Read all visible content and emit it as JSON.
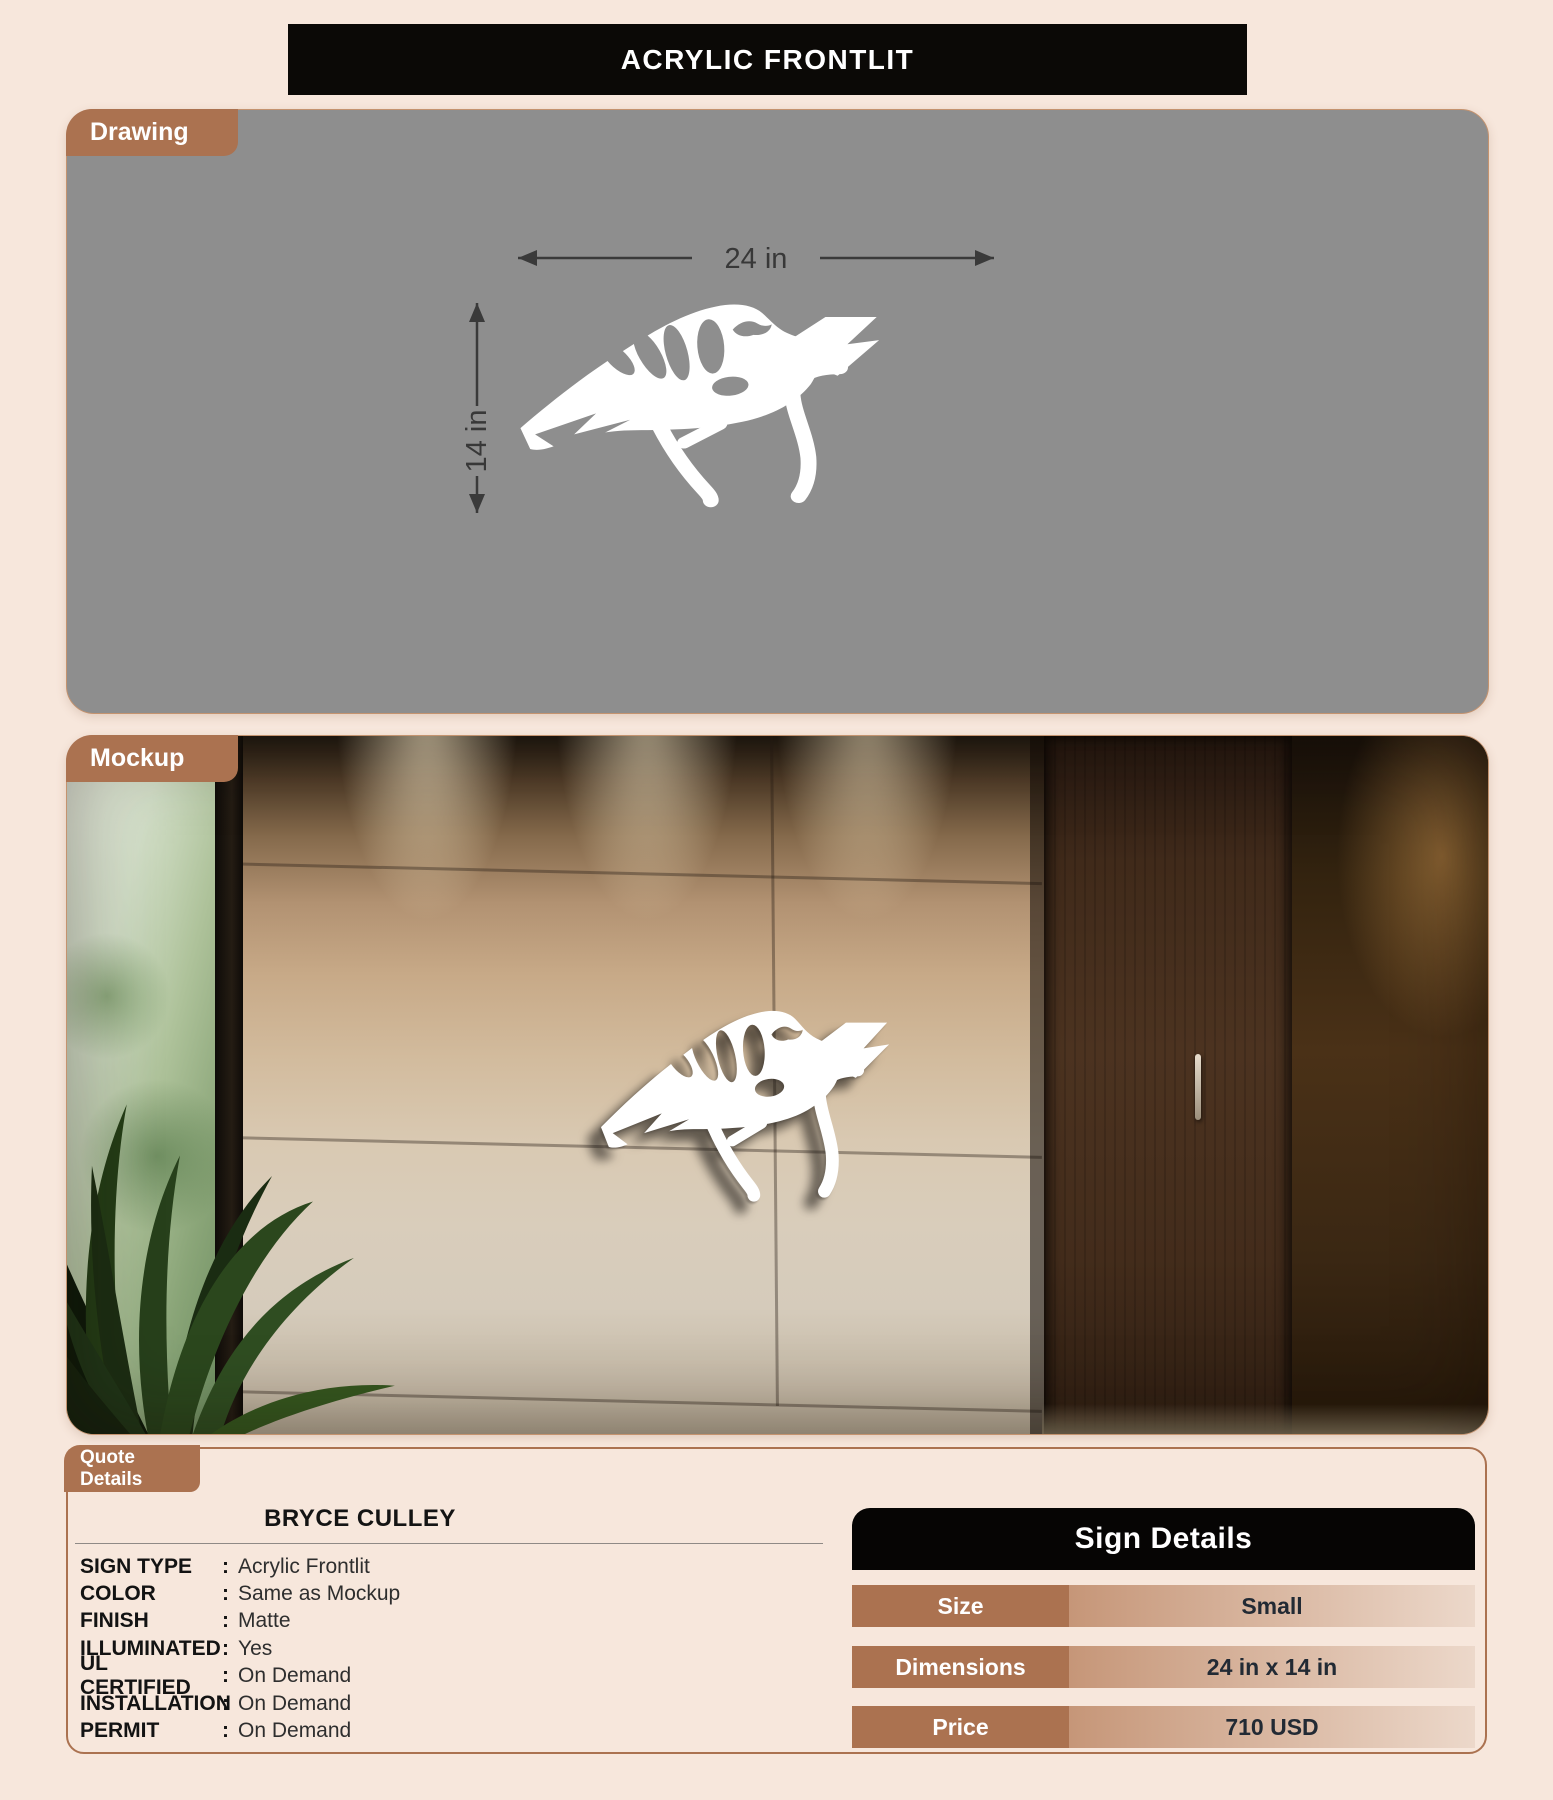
{
  "header": {
    "title": "ACRYLIC FRONTLIT"
  },
  "colors": {
    "page_background": "#f7e7dc",
    "accent_copper": "#ab7250",
    "drawing_canvas": "#8e8e8e",
    "header_black": "#0b0906",
    "value_cell_gradient_start": "#c69678",
    "value_cell_gradient_end": "#ecd8ca"
  },
  "sections": {
    "drawing": {
      "label": "Drawing",
      "width_dimension": "24 in",
      "height_dimension": "14 in"
    },
    "mockup": {
      "label": "Mockup"
    },
    "quote": {
      "label": "Quote Details",
      "customer_name": "BRYCE CULLEY",
      "separator": ":",
      "fields": [
        {
          "label": "SIGN TYPE",
          "value": "Acrylic Frontlit"
        },
        {
          "label": "COLOR",
          "value": "Same as Mockup"
        },
        {
          "label": "FINISH",
          "value": "Matte"
        },
        {
          "label": "ILLUMINATED",
          "value": "Yes"
        },
        {
          "label": "UL CERTIFIED",
          "value": "On Demand"
        },
        {
          "label": "INSTALLATION",
          "value": "On Demand"
        },
        {
          "label": "PERMIT",
          "value": "On Demand"
        }
      ],
      "sign_details": {
        "title": "Sign Details",
        "rows": [
          {
            "label": "Size",
            "value": "Small"
          },
          {
            "label": "Dimensions",
            "value": "24 in x 14 in"
          },
          {
            "label": "Price",
            "value": "710 USD"
          }
        ]
      }
    }
  }
}
